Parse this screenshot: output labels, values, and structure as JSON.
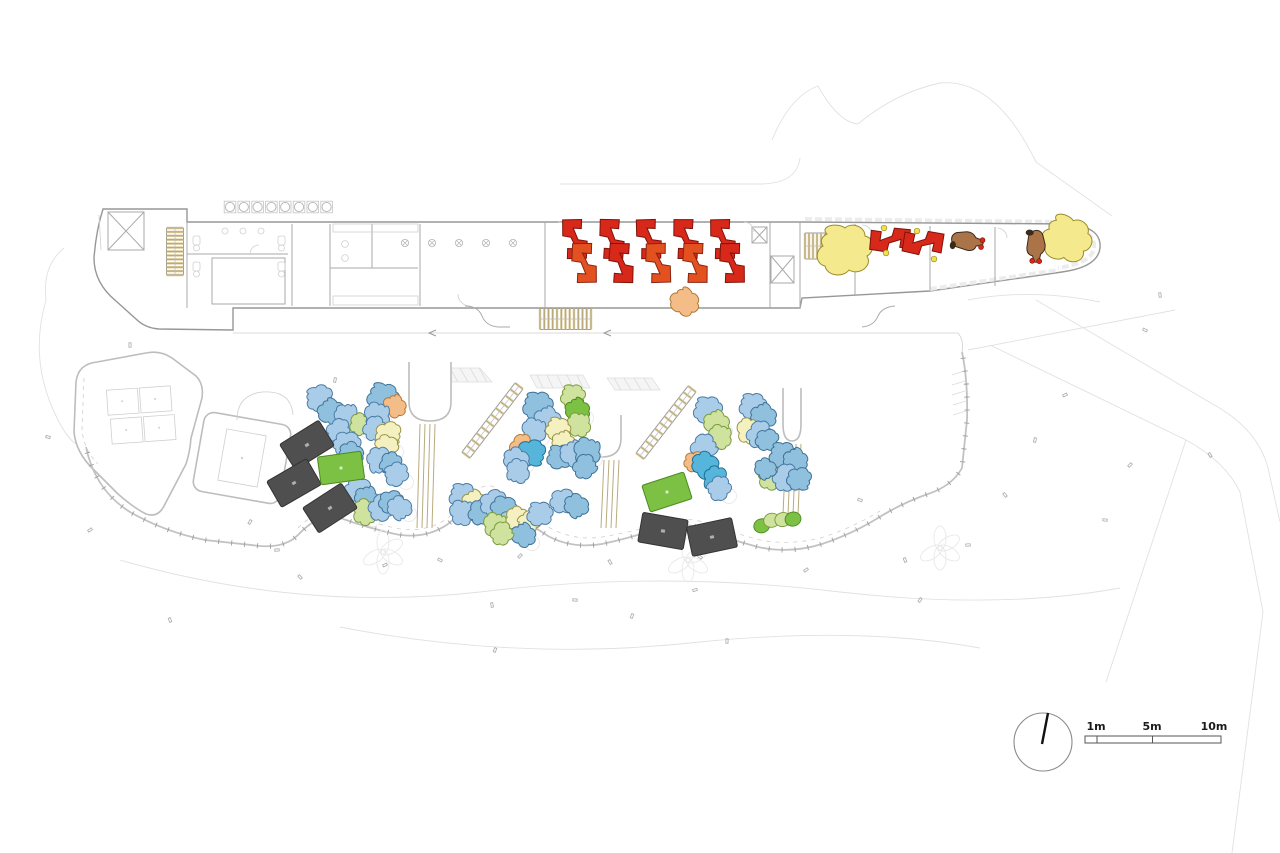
{
  "document": {
    "kind": "architectural-ground-floor-plan"
  },
  "annotations": {
    "north_arrow_icon": "north-arrow",
    "scale_bar": {
      "labels": [
        "1m",
        "5m",
        "10m"
      ]
    }
  },
  "palette": {
    "red": [
      "#d7281a",
      "#7e130a"
    ],
    "red2": [
      "#e2511f",
      "#8a2410"
    ],
    "brown": [
      "#aa7448",
      "#3d2917"
    ],
    "yellow": [
      "#f4e98d",
      "#9a8c2a"
    ],
    "orange": [
      "#f4bd88",
      "#b07838"
    ],
    "lightblue": [
      "#a9cde8",
      "#4a7ba6"
    ],
    "blue2": [
      "#8fc0de",
      "#3f7196"
    ],
    "cyan": [
      "#55b5da",
      "#1f6e94"
    ],
    "paleyellow": [
      "#f4f0c0",
      "#9a9249"
    ],
    "yellowgreen": [
      "#cfe29e",
      "#7a9a3e"
    ],
    "green": [
      "#7cc143",
      "#4c8a1e"
    ],
    "mat": [
      "#4f4f4f",
      "#333333"
    ],
    "stair": [
      "#d8c89c",
      "#9a8c5a"
    ]
  },
  "furniture": {
    "red_desks": [
      [
        575,
        239,
        -4,
        "red"
      ],
      [
        584,
        263,
        176,
        "red2"
      ],
      [
        612,
        239,
        -2,
        "red"
      ],
      [
        621,
        263,
        178,
        "red"
      ],
      [
        649,
        239,
        -5,
        "red"
      ],
      [
        658,
        263,
        175,
        "red2"
      ],
      [
        686,
        239,
        -3,
        "red"
      ],
      [
        695,
        263,
        177,
        "red2"
      ],
      [
        723,
        239,
        -4,
        "red"
      ],
      [
        732,
        263,
        176,
        "red"
      ],
      [
        890,
        240,
        92,
        "red"
      ],
      [
        923,
        243,
        96,
        "red"
      ]
    ],
    "accent_dots": [
      [
        884,
        228
      ],
      [
        886,
        253
      ],
      [
        917,
        231
      ],
      [
        934,
        259
      ]
    ],
    "animals": [
      [
        967,
        241,
        -78
      ],
      [
        1036,
        246,
        3
      ]
    ],
    "sand_blobs": [
      [
        845,
        252,
        0,
        "yellow",
        2.0
      ],
      [
        1066,
        241,
        20,
        "yellow",
        1.8
      ],
      [
        684,
        303,
        40,
        "orange",
        1.05
      ]
    ],
    "mats": [
      [
        307,
        445,
        -32
      ],
      [
        294,
        483,
        -30
      ],
      [
        330,
        508,
        -33
      ],
      [
        663,
        531,
        10
      ],
      [
        712,
        537,
        -12
      ]
    ],
    "tables": [
      [
        341,
        468,
        -8
      ],
      [
        667,
        492,
        -18
      ]
    ],
    "caterpillar": [
      777,
      521,
      -14
    ],
    "play_blobs": [
      [
        320,
        399,
        -20,
        "lightblue",
        1
      ],
      [
        331,
        413,
        30,
        "blue2",
        1
      ],
      [
        346,
        417,
        70,
        "lightblue",
        0.95
      ],
      [
        359,
        424,
        110,
        "yellowgreen",
        0.8
      ],
      [
        338,
        430,
        150,
        "lightblue",
        0.9
      ],
      [
        347,
        443,
        190,
        "lightblue",
        1
      ],
      [
        352,
        453,
        230,
        "blue2",
        0.9
      ],
      [
        383,
        399,
        10,
        "blue2",
        1.15
      ],
      [
        394,
        407,
        50,
        "orange",
        0.85
      ],
      [
        376,
        416,
        90,
        "lightblue",
        1
      ],
      [
        374,
        428,
        130,
        "lightblue",
        0.9
      ],
      [
        388,
        433,
        170,
        "paleyellow",
        0.95
      ],
      [
        387,
        445,
        210,
        "paleyellow",
        0.85
      ],
      [
        381,
        460,
        250,
        "lightblue",
        1
      ],
      [
        392,
        464,
        290,
        "blue2",
        0.85
      ],
      [
        397,
        475,
        330,
        "lightblue",
        0.9
      ],
      [
        358,
        491,
        20,
        "lightblue",
        1
      ],
      [
        366,
        499,
        60,
        "blue2",
        0.9
      ],
      [
        364,
        512,
        100,
        "yellowgreen",
        0.95
      ],
      [
        381,
        507,
        140,
        "lightblue",
        1
      ],
      [
        391,
        501,
        180,
        "blue2",
        0.9
      ],
      [
        400,
        507,
        220,
        "lightblue",
        0.9
      ],
      [
        538,
        407,
        0,
        "blue2",
        1.1
      ],
      [
        547,
        421,
        45,
        "lightblue",
        1
      ],
      [
        533,
        431,
        90,
        "lightblue",
        0.95
      ],
      [
        521,
        446,
        135,
        "orange",
        0.9
      ],
      [
        531,
        452,
        180,
        "cyan",
        1.05
      ],
      [
        517,
        459,
        225,
        "lightblue",
        0.95
      ],
      [
        519,
        471,
        270,
        "lightblue",
        0.9
      ],
      [
        573,
        397,
        0,
        "yellowgreen",
        0.9
      ],
      [
        577,
        411,
        40,
        "green",
        0.9
      ],
      [
        578,
        425,
        80,
        "yellowgreen",
        0.9
      ],
      [
        558,
        430,
        10,
        "paleyellow",
        0.9
      ],
      [
        563,
        443,
        50,
        "paleyellow",
        0.85
      ],
      [
        560,
        458,
        0,
        "blue2",
        0.95
      ],
      [
        573,
        455,
        45,
        "lightblue",
        1
      ],
      [
        586,
        452,
        90,
        "blue2",
        1.05
      ],
      [
        584,
        466,
        135,
        "blue2",
        0.9
      ],
      [
        463,
        497,
        0,
        "lightblue",
        1
      ],
      [
        474,
        503,
        40,
        "paleyellow",
        0.9
      ],
      [
        461,
        513,
        80,
        "lightblue",
        0.95
      ],
      [
        479,
        512,
        120,
        "blue2",
        0.9
      ],
      [
        493,
        502,
        160,
        "lightblue",
        1
      ],
      [
        504,
        507,
        200,
        "blue2",
        0.95
      ],
      [
        512,
        522,
        240,
        "lightblue",
        0.9
      ],
      [
        518,
        519,
        280,
        "paleyellow",
        0.9
      ],
      [
        530,
        523,
        320,
        "paleyellow",
        0.85
      ],
      [
        540,
        515,
        0,
        "lightblue",
        0.95
      ],
      [
        523,
        536,
        45,
        "blue2",
        0.9
      ],
      [
        494,
        525,
        90,
        "yellowgreen",
        0.9
      ],
      [
        501,
        533,
        135,
        "yellowgreen",
        0.85
      ],
      [
        563,
        500,
        180,
        "lightblue",
        0.95
      ],
      [
        577,
        505,
        225,
        "blue2",
        0.9
      ],
      [
        708,
        411,
        0,
        "lightblue",
        1.05
      ],
      [
        716,
        424,
        45,
        "yellowgreen",
        0.95
      ],
      [
        719,
        437,
        90,
        "yellowgreen",
        0.9
      ],
      [
        703,
        447,
        135,
        "lightblue",
        1
      ],
      [
        695,
        461,
        180,
        "orange",
        0.8
      ],
      [
        706,
        464,
        225,
        "cyan",
        1
      ],
      [
        717,
        479,
        270,
        "cyan",
        0.95
      ],
      [
        720,
        489,
        315,
        "lightblue",
        0.9
      ],
      [
        753,
        407,
        0,
        "lightblue",
        1
      ],
      [
        763,
        417,
        45,
        "blue2",
        0.95
      ],
      [
        748,
        431,
        90,
        "paleyellow",
        0.95
      ],
      [
        759,
        434,
        135,
        "lightblue",
        1
      ],
      [
        767,
        439,
        180,
        "blue2",
        0.85
      ],
      [
        783,
        456,
        0,
        "blue2",
        1
      ],
      [
        795,
        461,
        45,
        "blue2",
        0.9
      ],
      [
        769,
        477,
        90,
        "yellowgreen",
        0.95
      ],
      [
        785,
        477,
        135,
        "lightblue",
        1
      ],
      [
        799,
        478,
        180,
        "blue2",
        0.9
      ],
      [
        766,
        468,
        225,
        "blue2",
        0.8
      ]
    ]
  },
  "structures": {
    "stairs": [
      {
        "x1": 175,
        "y1": 228,
        "x2": 175,
        "y2": 275,
        "w": 17,
        "n": 12
      },
      {
        "x1": 540,
        "y1": 319,
        "x2": 591,
        "y2": 319,
        "w": 21,
        "n": 12
      },
      {
        "x1": 805,
        "y1": 246,
        "x2": 841,
        "y2": 246,
        "w": 26,
        "n": 9
      },
      {
        "x1": 519,
        "y1": 386,
        "x2": 466,
        "y2": 455,
        "w": 10,
        "n": 11
      },
      {
        "x1": 692,
        "y1": 389,
        "x2": 640,
        "y2": 456,
        "w": 10,
        "n": 11
      }
    ],
    "rails": [
      {
        "x": 420,
        "y1": 424,
        "y2": 528,
        "n": 4,
        "dx": 5
      },
      {
        "x": 604,
        "y1": 460,
        "y2": 528,
        "n": 4,
        "dx": 5
      },
      {
        "x": 786,
        "y1": 444,
        "y2": 515,
        "n": 4,
        "dx": 5
      }
    ],
    "kitchen_equipment": {
      "x0": 230,
      "y": 207,
      "step": 13.8,
      "count": 8
    },
    "hall_columns": {
      "y": 243,
      "xs": [
        405,
        432,
        459,
        486,
        513
      ]
    },
    "tree_clusters": [
      [
        383,
        552
      ],
      [
        688,
        560
      ],
      [
        940,
        548
      ]
    ]
  },
  "survey_marks": [
    [
      130,
      345
    ],
    [
      90,
      530
    ],
    [
      48,
      437
    ],
    [
      170,
      620
    ],
    [
      250,
      522
    ],
    [
      277,
      550
    ],
    [
      300,
      577
    ],
    [
      335,
      380
    ],
    [
      385,
      565
    ],
    [
      440,
      560
    ],
    [
      492,
      605
    ],
    [
      520,
      556
    ],
    [
      575,
      600
    ],
    [
      610,
      562
    ],
    [
      632,
      616
    ],
    [
      695,
      590
    ],
    [
      700,
      557
    ],
    [
      727,
      641
    ],
    [
      806,
      570
    ],
    [
      860,
      500
    ],
    [
      905,
      560
    ],
    [
      920,
      600
    ],
    [
      968,
      545
    ],
    [
      1005,
      495
    ],
    [
      1035,
      440
    ],
    [
      1065,
      395
    ],
    [
      1145,
      330
    ],
    [
      1160,
      295
    ],
    [
      1130,
      465
    ],
    [
      1105,
      520
    ],
    [
      1210,
      455
    ],
    [
      495,
      650
    ]
  ]
}
